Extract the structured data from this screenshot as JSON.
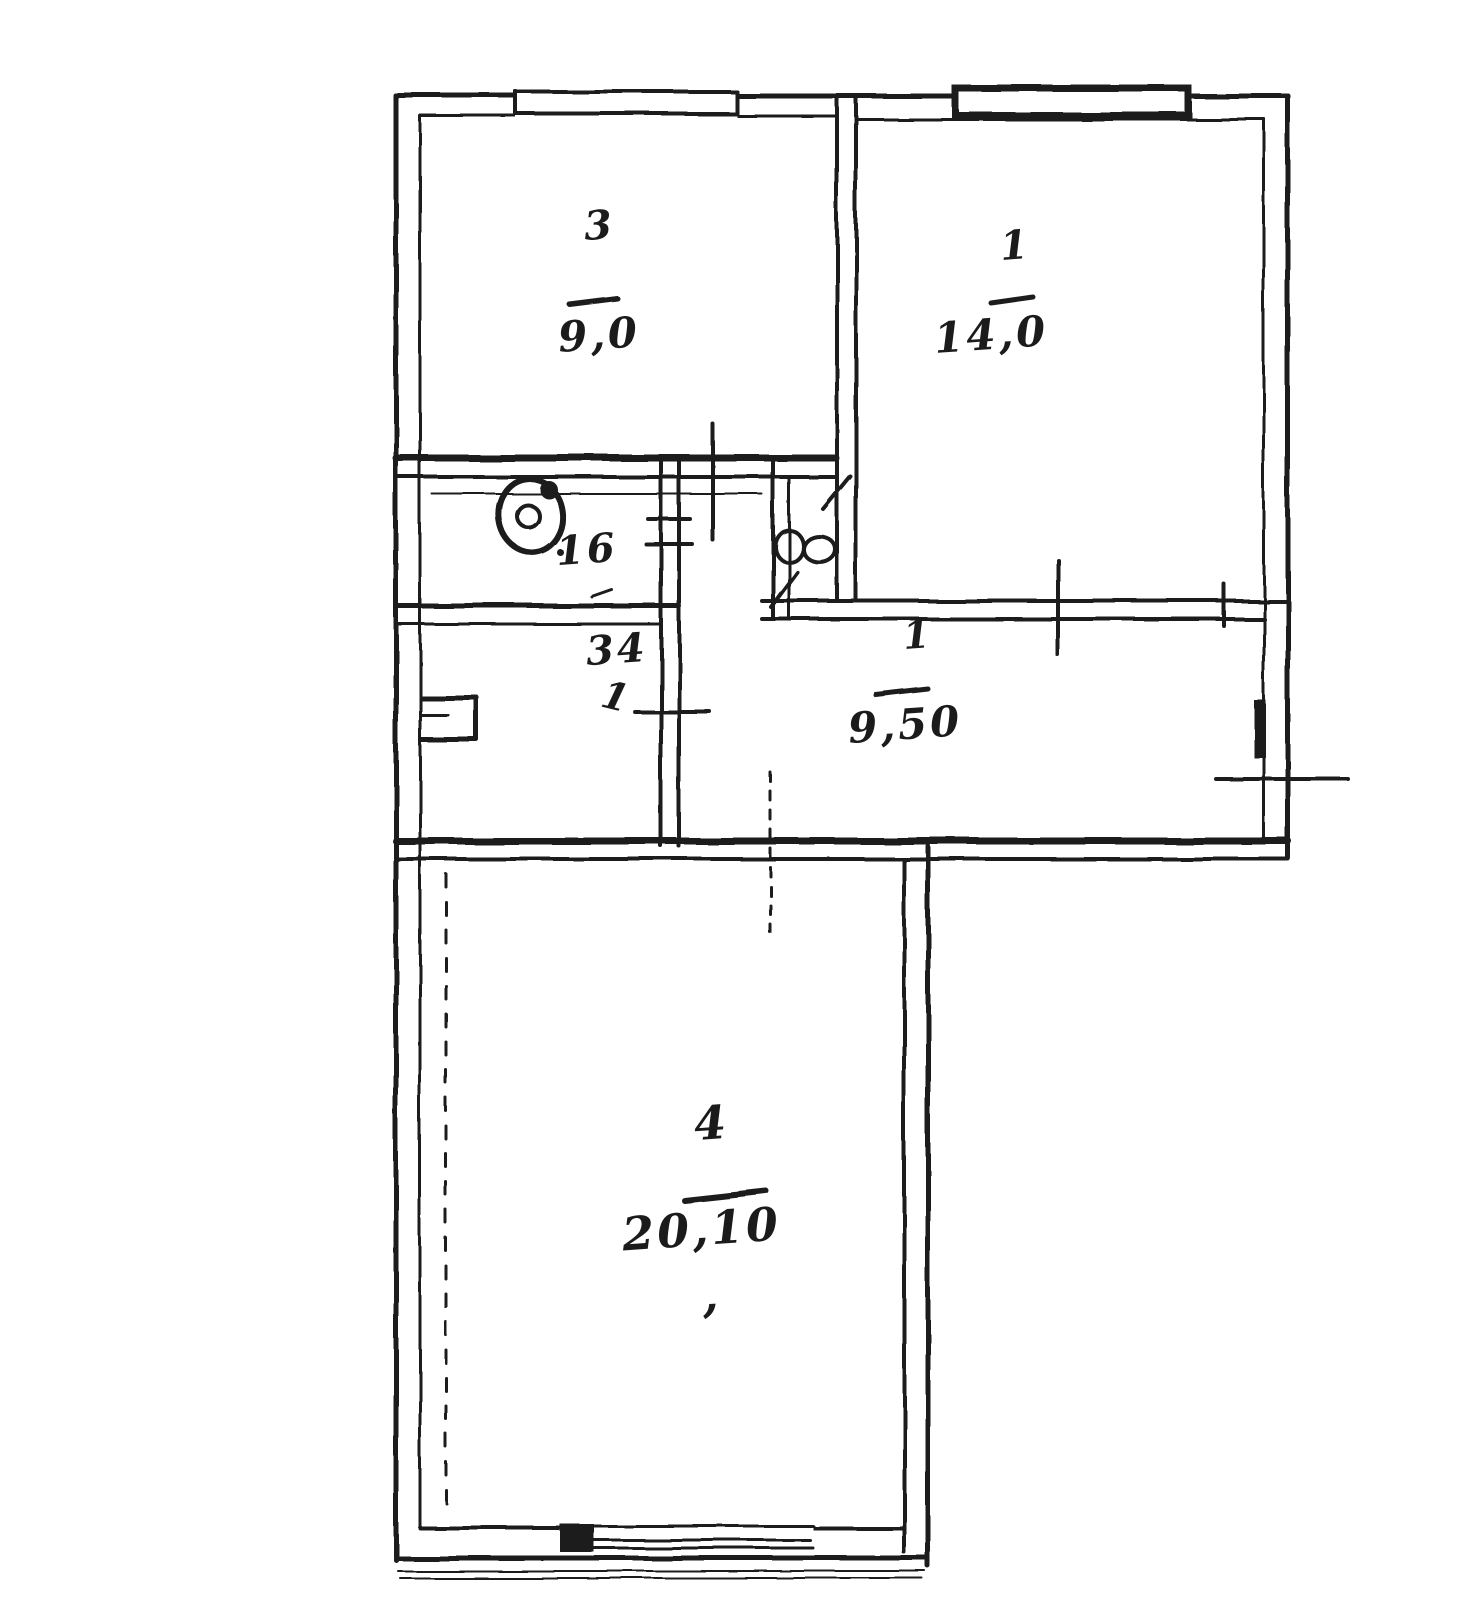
{
  "plan": {
    "rooms": [
      {
        "number": "3",
        "area": "9,0"
      },
      {
        "number": "1",
        "area": "14,0"
      },
      {
        "number": "1",
        "area": "9,50"
      },
      {
        "number": "4",
        "area": "20,10"
      }
    ],
    "dimensions": {
      "wc_wall": "16",
      "inner_wall": "34",
      "door_mark": "1",
      "stray_comma": ","
    },
    "icons": {
      "toilet": "toilet-icon",
      "door_swing": "door-swing-icon",
      "window_top_left": "window-icon",
      "window_top_right": "window-icon",
      "window_bottom": "window-icon"
    },
    "colors": {
      "ink": "#1c1c1c",
      "paper": "#ffffff"
    }
  }
}
